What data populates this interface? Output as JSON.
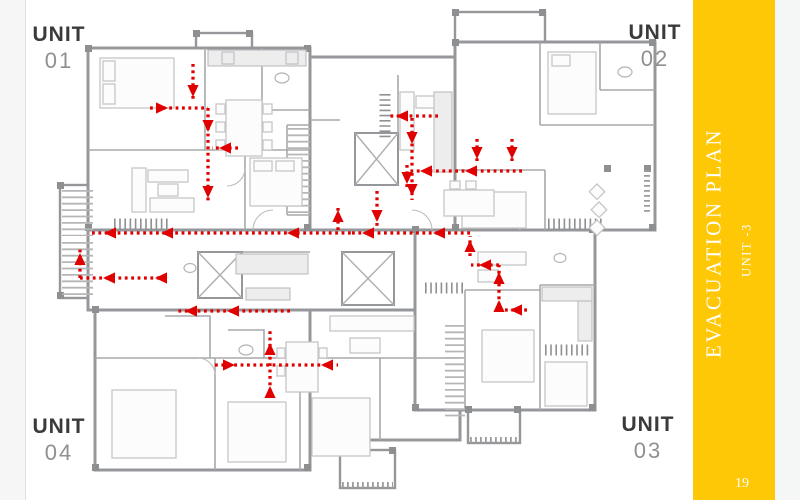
{
  "sidebar": {
    "title": "EVACUATION PLAN",
    "subtitle": "UNIT -3",
    "page_number": "19",
    "accent_color": "#FFC807",
    "text_color": "#FFFFFF"
  },
  "units": [
    {
      "label": "UNIT",
      "number": "01",
      "position": "top-left"
    },
    {
      "label": "UNIT",
      "number": "02",
      "position": "top-right"
    },
    {
      "label": "UNIT",
      "number": "03",
      "position": "bottom-right"
    },
    {
      "label": "UNIT",
      "number": "04",
      "position": "bottom-left"
    }
  ],
  "floorplan": {
    "type": "evacuation-floor-plan",
    "route_color": "#E00000",
    "wall_color": "#96979A",
    "routes": [
      {
        "pts": [
          [
            193,
            64
          ],
          [
            193,
            100
          ]
        ],
        "arrows": [
          {
            "x": 193,
            "y": 96,
            "d": "down"
          }
        ]
      },
      {
        "pts": [
          [
            150,
            108
          ],
          [
            208,
            108
          ]
        ],
        "arrows": [
          {
            "x": 167,
            "y": 108,
            "d": "right"
          }
        ]
      },
      {
        "pts": [
          [
            208,
            108
          ],
          [
            208,
            203
          ]
        ],
        "arrows": [
          {
            "x": 208,
            "y": 131,
            "d": "down"
          },
          {
            "x": 208,
            "y": 197,
            "d": "down"
          }
        ]
      },
      {
        "pts": [
          [
            238,
            148
          ],
          [
            212,
            148
          ]
        ],
        "arrows": [
          {
            "x": 220,
            "y": 148,
            "d": "left"
          }
        ]
      },
      {
        "pts": [
          [
            92,
            233
          ],
          [
            352,
            233
          ]
        ],
        "arrows": [
          {
            "x": 105,
            "y": 233,
            "d": "left"
          },
          {
            "x": 162,
            "y": 233,
            "d": "left"
          },
          {
            "x": 288,
            "y": 233,
            "d": "left"
          }
        ]
      },
      {
        "pts": [
          [
            352,
            233
          ],
          [
            470,
            233
          ]
        ],
        "arrows": [
          {
            "x": 363,
            "y": 233,
            "d": "left"
          },
          {
            "x": 434,
            "y": 233,
            "d": "left"
          }
        ]
      },
      {
        "pts": [
          [
            166,
            278
          ],
          [
            80,
            278
          ]
        ],
        "arrows": [
          {
            "x": 156,
            "y": 278,
            "d": "left"
          },
          {
            "x": 104,
            "y": 278,
            "d": "left"
          }
        ]
      },
      {
        "pts": [
          [
            80,
            278
          ],
          [
            80,
            248
          ]
        ],
        "arrows": [
          {
            "x": 80,
            "y": 254,
            "d": "up"
          }
        ]
      },
      {
        "pts": [
          [
            338,
            230
          ],
          [
            338,
            206
          ]
        ],
        "arrows": [
          {
            "x": 338,
            "y": 211,
            "d": "up"
          }
        ]
      },
      {
        "pts": [
          [
            377,
            191
          ],
          [
            377,
            229
          ]
        ],
        "arrows": [
          {
            "x": 377,
            "y": 221,
            "d": "down"
          }
        ]
      },
      {
        "pts": [
          [
            407,
            165
          ],
          [
            407,
            189
          ]
        ],
        "arrows": [
          {
            "x": 407,
            "y": 183,
            "d": "down"
          }
        ]
      },
      {
        "pts": [
          [
            438,
            116
          ],
          [
            388,
            116
          ]
        ],
        "arrows": [
          {
            "x": 397,
            "y": 116,
            "d": "left"
          }
        ]
      },
      {
        "pts": [
          [
            412,
            118
          ],
          [
            412,
            166
          ]
        ],
        "arrows": [
          {
            "x": 412,
            "y": 143,
            "d": "down"
          }
        ]
      },
      {
        "pts": [
          [
            477,
            139
          ],
          [
            477,
            164
          ]
        ],
        "arrows": [
          {
            "x": 477,
            "y": 158,
            "d": "down"
          }
        ]
      },
      {
        "pts": [
          [
            512,
            139
          ],
          [
            512,
            164
          ]
        ],
        "arrows": [
          {
            "x": 512,
            "y": 158,
            "d": "down"
          }
        ]
      },
      {
        "pts": [
          [
            522,
            171
          ],
          [
            410,
            171
          ]
        ],
        "arrows": [
          {
            "x": 466,
            "y": 171,
            "d": "left"
          },
          {
            "x": 421,
            "y": 171,
            "d": "left"
          }
        ]
      },
      {
        "pts": [
          [
            412,
            173
          ],
          [
            412,
            200
          ]
        ],
        "arrows": [
          {
            "x": 412,
            "y": 195,
            "d": "down"
          }
        ]
      },
      {
        "pts": [
          [
            470,
            256
          ],
          [
            470,
            236
          ]
        ],
        "arrows": [
          {
            "x": 470,
            "y": 241,
            "d": "up"
          }
        ]
      },
      {
        "pts": [
          [
            499,
            265
          ],
          [
            471,
            265
          ]
        ],
        "arrows": [
          {
            "x": 480,
            "y": 265,
            "d": "left"
          }
        ]
      },
      {
        "pts": [
          [
            499,
            312
          ],
          [
            499,
            265
          ]
        ],
        "arrows": [
          {
            "x": 499,
            "y": 301,
            "d": "up"
          },
          {
            "x": 499,
            "y": 273,
            "d": "up"
          }
        ]
      },
      {
        "pts": [
          [
            527,
            310
          ],
          [
            502,
            310
          ]
        ],
        "arrows": [
          {
            "x": 511,
            "y": 310,
            "d": "left"
          }
        ]
      },
      {
        "pts": [
          [
            290,
            311
          ],
          [
            175,
            311
          ]
        ],
        "arrows": [
          {
            "x": 228,
            "y": 311,
            "d": "left"
          },
          {
            "x": 186,
            "y": 311,
            "d": "left"
          }
        ]
      },
      {
        "pts": [
          [
            215,
            365
          ],
          [
            338,
            365
          ]
        ],
        "arrows": [
          {
            "x": 234,
            "y": 365,
            "d": "right"
          },
          {
            "x": 322,
            "y": 365,
            "d": "left"
          }
        ]
      },
      {
        "pts": [
          [
            270,
            398
          ],
          [
            270,
            328
          ]
        ],
        "arrows": [
          {
            "x": 270,
            "y": 387,
            "d": "up"
          },
          {
            "x": 270,
            "y": 344,
            "d": "up"
          }
        ]
      }
    ]
  }
}
